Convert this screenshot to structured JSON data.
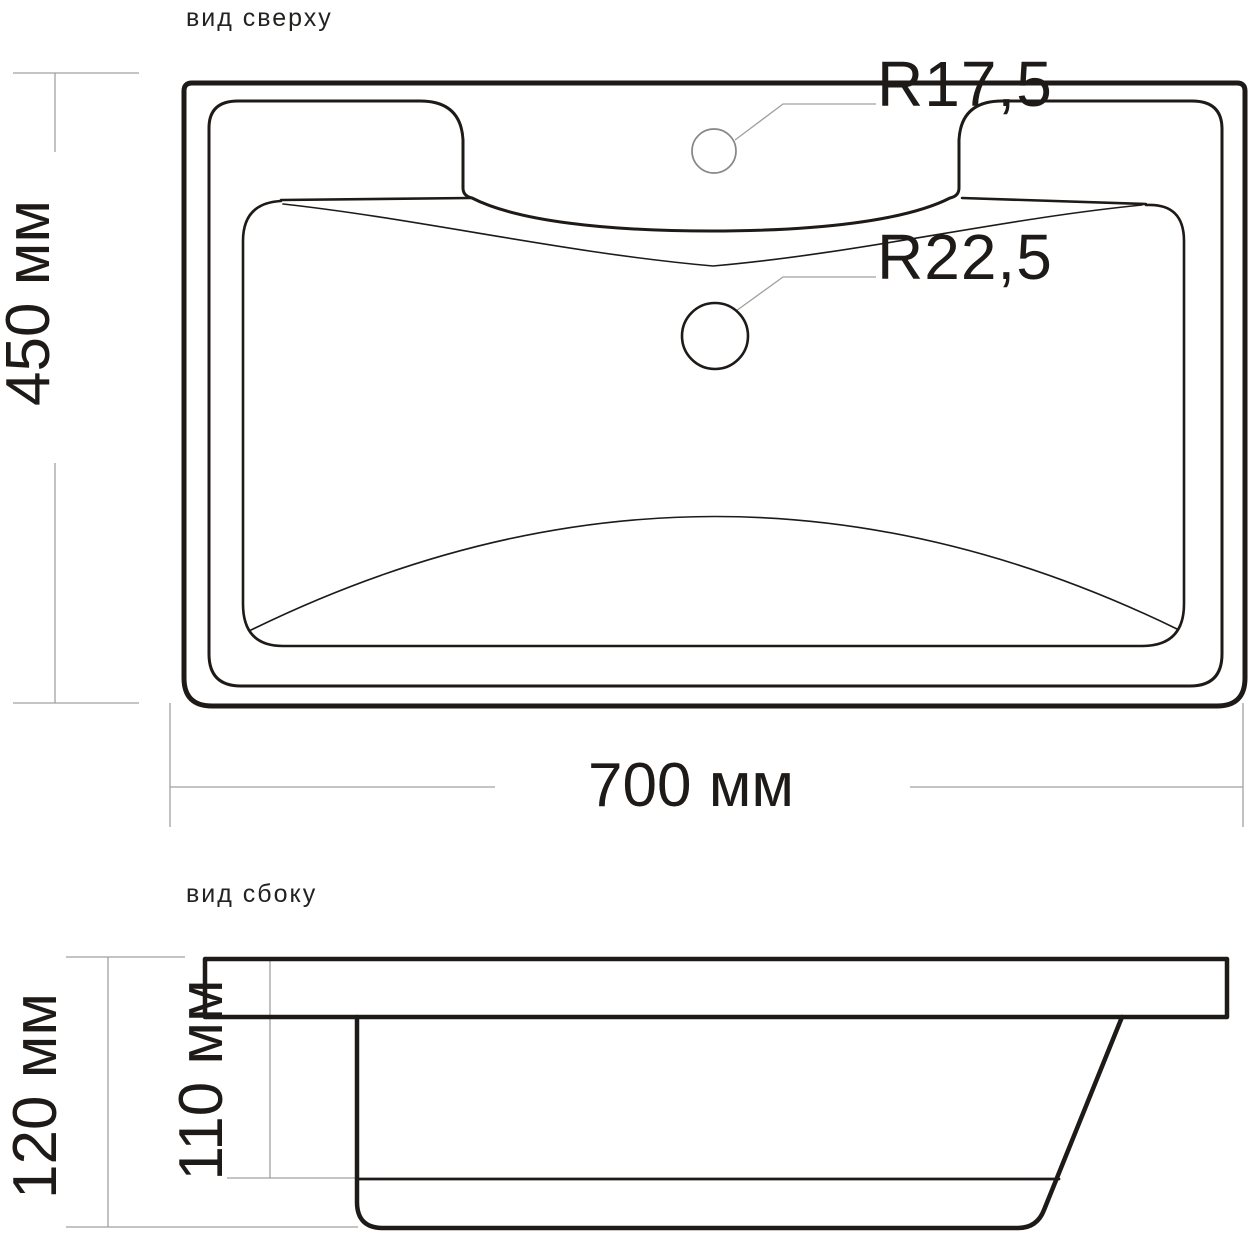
{
  "top_view": {
    "title": "вид сверху",
    "width_dimension": "700 мм",
    "depth_dimension": "450 мм",
    "faucet_hole_radius": "R17,5",
    "overflow_hole_radius": "R22,5"
  },
  "side_view": {
    "title": "вид сбоку",
    "overall_height_dimension": "120 мм",
    "inner_depth_dimension": "110 мм"
  },
  "colors": {
    "line_black": "#1e1a17",
    "dimension_gray": "#a0a0a0",
    "hole_gray": "#878787",
    "background": "#ffffff"
  }
}
